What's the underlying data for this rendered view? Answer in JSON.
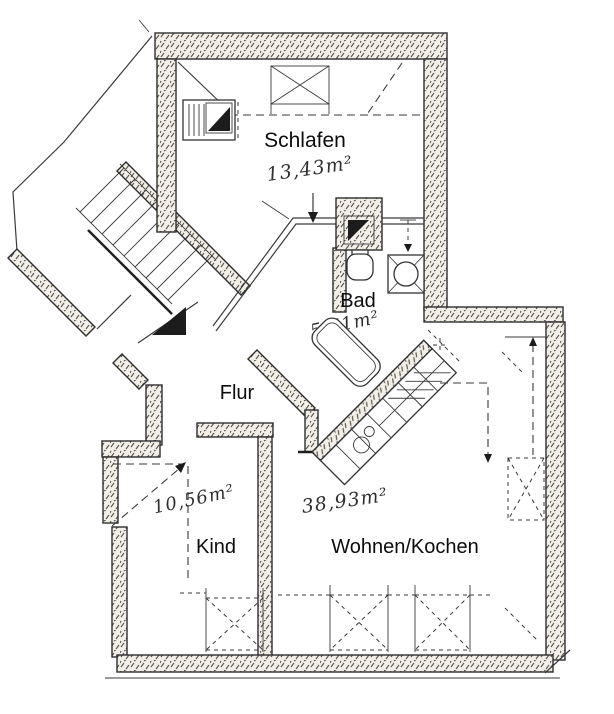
{
  "plan": {
    "rooms": {
      "schlafen": {
        "name": "Schlafen",
        "area": "13,43m²"
      },
      "bad": {
        "name": "Bad",
        "area": "5,61m²"
      },
      "flur": {
        "name": "Flur"
      },
      "kind": {
        "name": "Kind",
        "area": "10,56m²"
      },
      "wohnen": {
        "name": "Wohnen/Kochen",
        "area": "38,93m²"
      }
    },
    "colors": {
      "ink": "#2e2e2e",
      "paper": "#ffffff",
      "wall_fill": "#f2efe8"
    }
  }
}
